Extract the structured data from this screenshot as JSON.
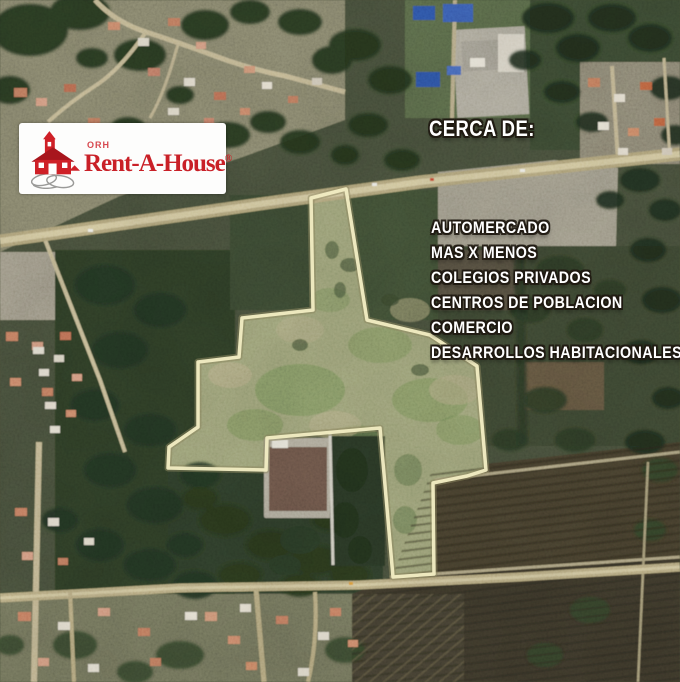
{
  "logo": {
    "company_prefix": "ORH",
    "company": "Rent-A-House",
    "registered_mark": "®",
    "brand_red": "#c92027"
  },
  "overlay": {
    "heading": "CERCA DE:",
    "items": [
      "AUTOMERCADO",
      "MAS X MENOS",
      "COLEGIOS PRIVADOS",
      "CENTROS DE POBLACION",
      "COMERCIO",
      "DESARROLLOS HABITACIONALES"
    ],
    "text_color": "#ffffff"
  },
  "map": {
    "property_outline_color": "#f3eec4"
  }
}
